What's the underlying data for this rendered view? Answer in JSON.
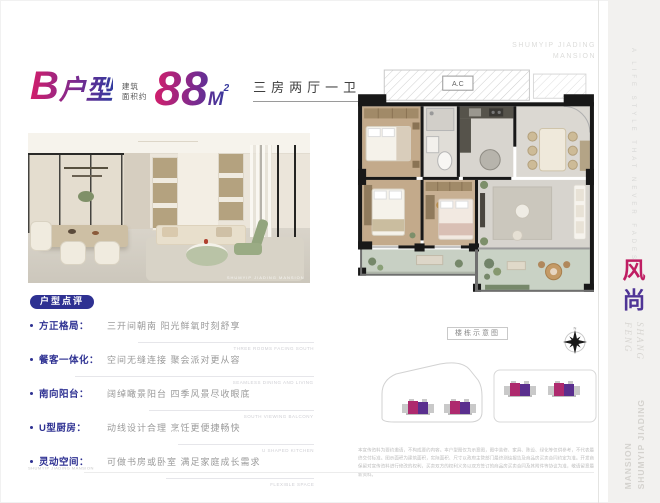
{
  "header": {
    "unit_big_letter": "B",
    "unit_name_rest": "户型",
    "area_label_line1": "建筑",
    "area_label_line2": "面积约",
    "area_value": "88",
    "area_unit_base": "M",
    "area_unit_sup": "2",
    "layout_tag": "三房两厅一卫"
  },
  "brand": {
    "name_line1": "SHUMYIP JIADING",
    "name_line2": "MANSION"
  },
  "hero": {
    "watermark": "SHUMYIP JIADING MANSION"
  },
  "review": {
    "badge_label": "户型点评",
    "items": [
      {
        "label": "方正格局：",
        "desc": "三开间朝南 阳光鲜氧时刻舒享",
        "caption": "THREE ROOMS FACING SOUTH"
      },
      {
        "label": "餐客一体化：",
        "desc": "空间无缝连接 聚会派对更从容",
        "caption": "SEAMLESS DINING AND LIVING"
      },
      {
        "label": "南向阳台：",
        "desc": "阔绰瞰景阳台 四季风景尽收眼底",
        "caption": "SOUTH VIEWING BALCONY"
      },
      {
        "label": "U型厨房：",
        "desc": "动线设计合理 烹饪更便捷畅快",
        "caption": "U SHAPED KITCHEN"
      },
      {
        "label": "灵动空间：",
        "desc": "可做书房或卧室 满足家庭成长需求",
        "caption": "FLEXIBLE SPACE"
      }
    ]
  },
  "floor_plan": {
    "ac_label": "A.C",
    "diagram_label": "楼栋示意图",
    "compass_north": "N"
  },
  "side_strip": {
    "tagline": "A LIFE STYLE THAT NEVER FADES",
    "cn_char_1": "风",
    "cn_char_2": "尚",
    "en_word_1": "FENG",
    "en_word_2": "SHANG",
    "brand_vertical_1": "SHUMYIP JIADING",
    "brand_vertical_2": "MANSION"
  },
  "footer": {
    "mark": "SHUMYIP JIADING MANSION"
  },
  "disclaimer": "本宣传资料为要约邀请，不构成要约内容。本户型图仅为示意图，图中装修、家具、陈设、绿化等仅供参考，不代表最终交付标准。图示面积为建筑面积，实际面积、尺寸以政府主管部门最终测绘报告及商品房买卖合同约定为准。开发商保留对宣传资料进行修改的权利，买卖双方的权利义务以双方签订的商品房买卖合同及其附件等协议为准，敬请留意最新资料。",
  "colors": {
    "accent_magenta": "#bf1e63",
    "accent_purple": "#4f3596",
    "badge_blue": "#2e3192",
    "wall_black": "#181818"
  }
}
